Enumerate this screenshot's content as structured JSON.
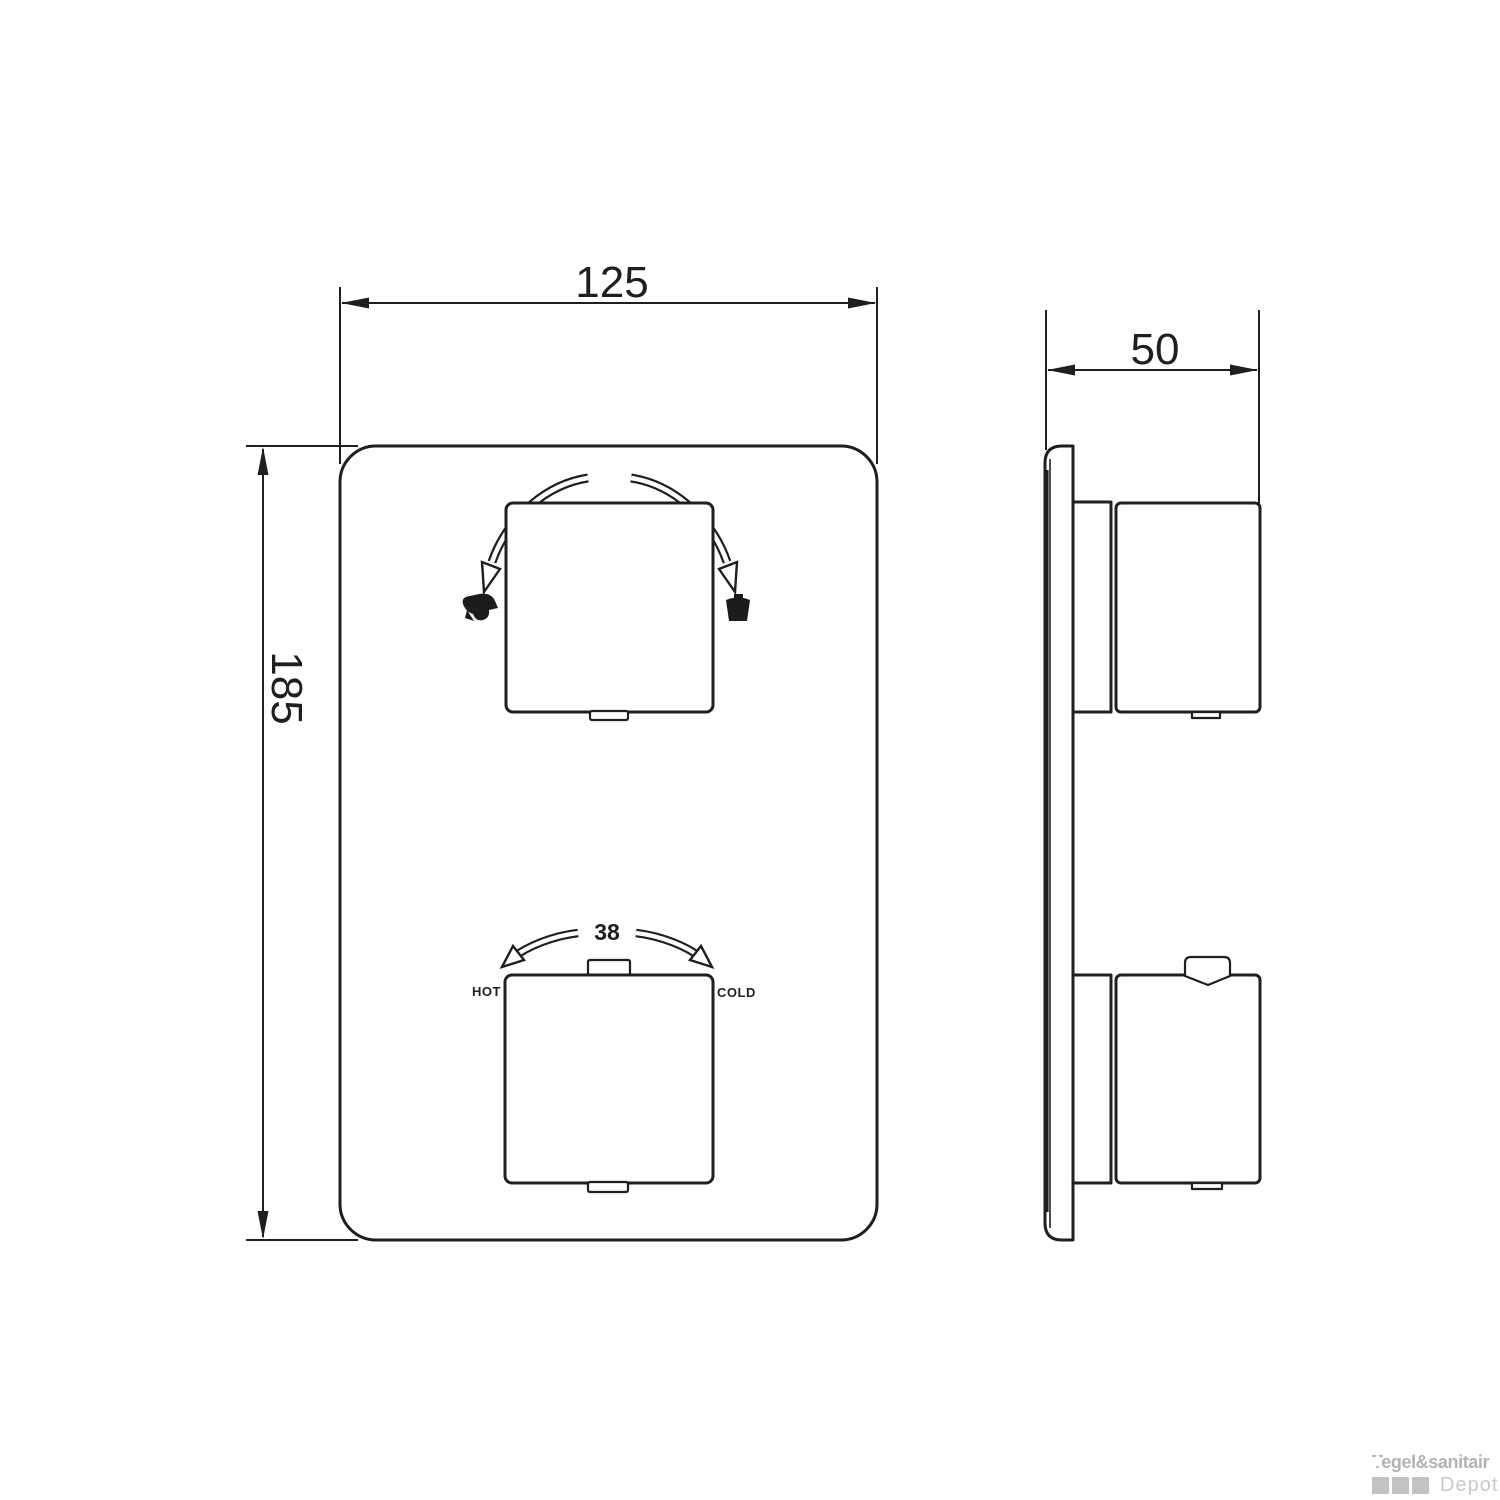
{
  "drawing": {
    "front_view": {
      "width_dim": "125",
      "height_dim": "185",
      "temperature_dial": {
        "value_label": "38",
        "hot_label": "HOT",
        "cold_label": "COLD"
      }
    },
    "side_view": {
      "depth_dim": "50"
    }
  },
  "watermark": {
    "brand": "Tegel&sanitair",
    "sub_brand": "Depot"
  },
  "colors": {
    "line": "#1f1f1f",
    "watermark_text": "#b3b3b3",
    "watermark_square": "#c3c3c3",
    "watermark_sub": "#c9c9c9"
  }
}
